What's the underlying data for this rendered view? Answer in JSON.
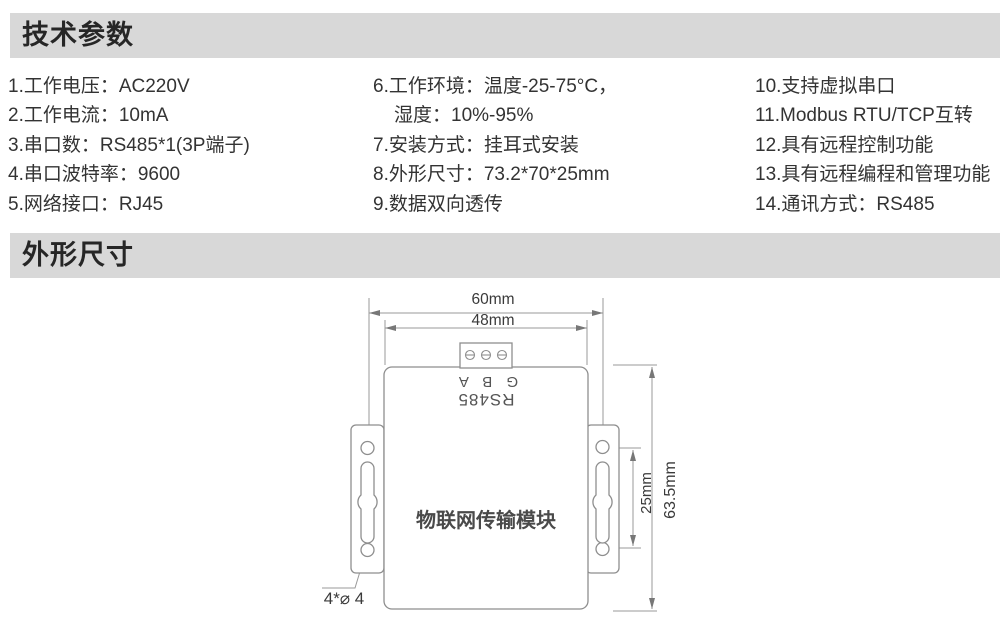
{
  "tech_params": {
    "title": "技术参数",
    "col1": [
      "1.工作电压：AC220V",
      "2.工作电流：10mA",
      "3.串口数：RS485*1(3P端子)",
      "4.串口波特率：9600",
      "5.网络接口：RJ45"
    ],
    "col2": [
      "6.工作环境：温度-25-75°C，",
      "湿度：10%-95%",
      "7.安装方式：挂耳式安装",
      "8.外形尺寸：73.2*70*25mm",
      "9.数据双向透传"
    ],
    "col3": [
      "10.支持虚拟串口",
      "11.Modbus RTU/TCP互转",
      "12.具有远程控制功能",
      "13.具有远程编程和管理功能",
      "14.通讯方式：RS485"
    ]
  },
  "dimensions": {
    "title": "外形尺寸",
    "width_outer": "60mm",
    "width_inner": "48mm",
    "hole_spacing": "25mm",
    "height_overall": "63.5mm",
    "hole_note": "4*⌀ 4",
    "device_label": "物联网传输模块",
    "port_label": "RS485",
    "port_pins": "G B A"
  },
  "colors": {
    "section_bar": "#d8d8d8",
    "heading_text": "#262626",
    "body_text": "#333333",
    "drawing_line": "#8e8e8e"
  }
}
